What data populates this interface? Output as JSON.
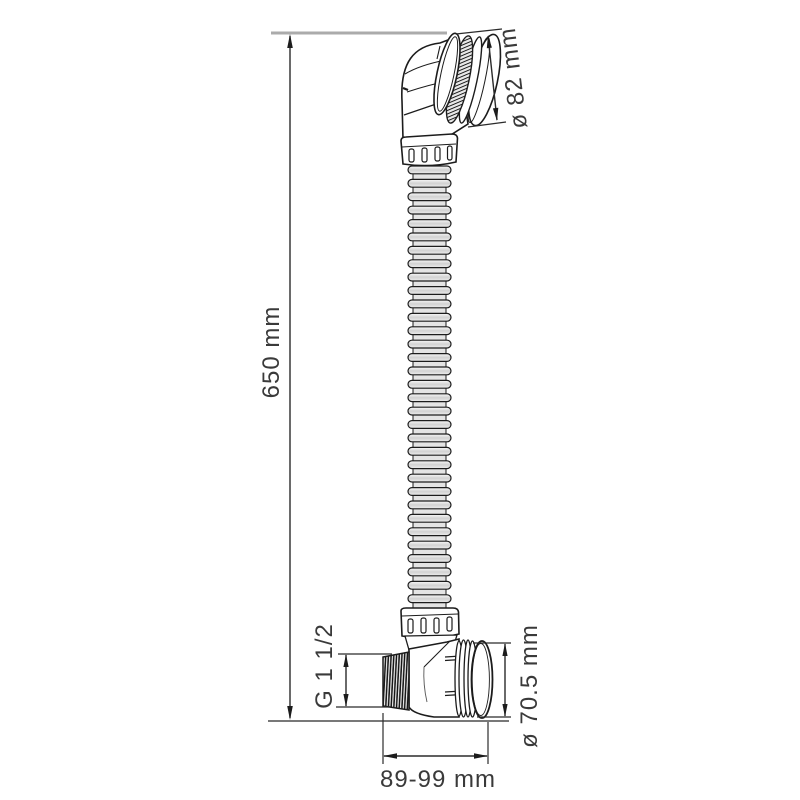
{
  "diagram": {
    "labels": {
      "height": "650 mm",
      "cap_diameter": "ø 82 mm",
      "thread_size": "G 1 1/2",
      "flange_diameter": "ø 70.5 mm",
      "width_range": "89-99 mm"
    },
    "colors": {
      "line": "#1c1c1c",
      "dimension": "#2b2b2b",
      "reference_line": "#ababab",
      "text": "#3a3a3a"
    }
  }
}
